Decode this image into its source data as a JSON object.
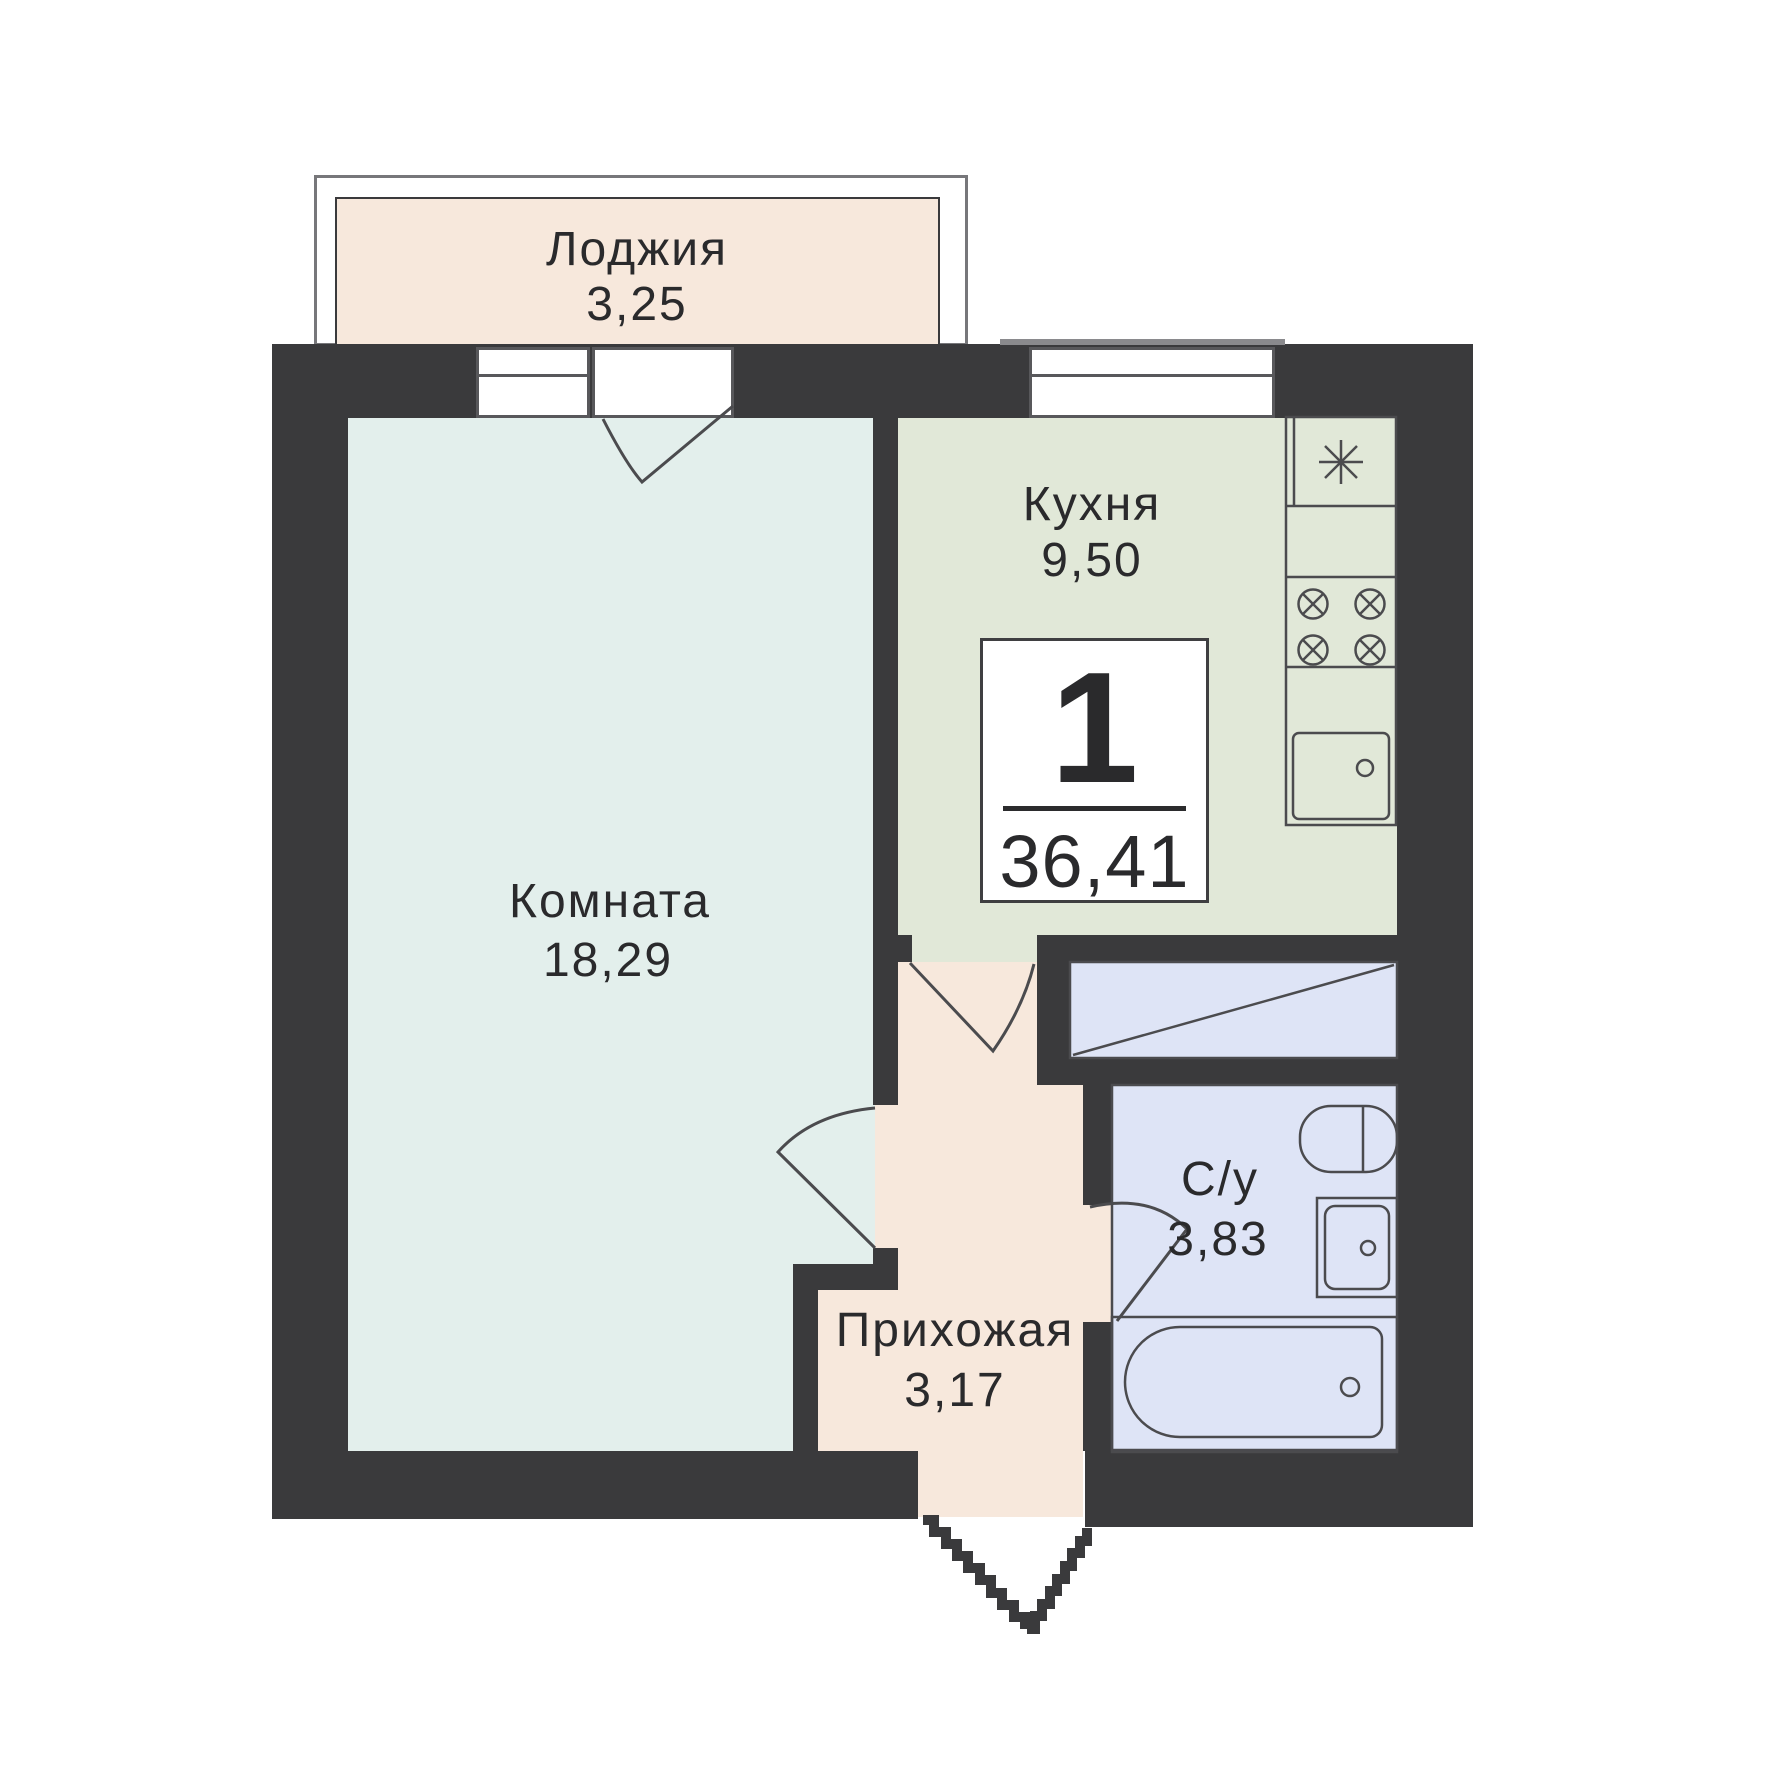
{
  "colors": {
    "wall": "#3a3a3c",
    "line": "#4b4b4e",
    "room": "#e3efec",
    "kitchen": "#e1e8d8",
    "peach": "#f7e8dc",
    "bath": "#dee4f6",
    "text": "#2a2a2c",
    "frame": "#58585b",
    "loggia_outline": "#77777a",
    "sill": "#8a8a8d",
    "white": "#ffffff"
  },
  "plan": {
    "badge": {
      "rooms_count": "1",
      "total_area": "36,41"
    },
    "rooms": {
      "loggia": {
        "name": "Лоджия",
        "area": "3,25"
      },
      "living_room": {
        "name": "Комната",
        "area": "18,29"
      },
      "kitchen": {
        "name": "Кухня",
        "area": "9,50"
      },
      "hallway": {
        "name": "Прихожая",
        "area": "3,17"
      },
      "bathroom": {
        "name": "С/у",
        "area": "3,83"
      }
    }
  }
}
